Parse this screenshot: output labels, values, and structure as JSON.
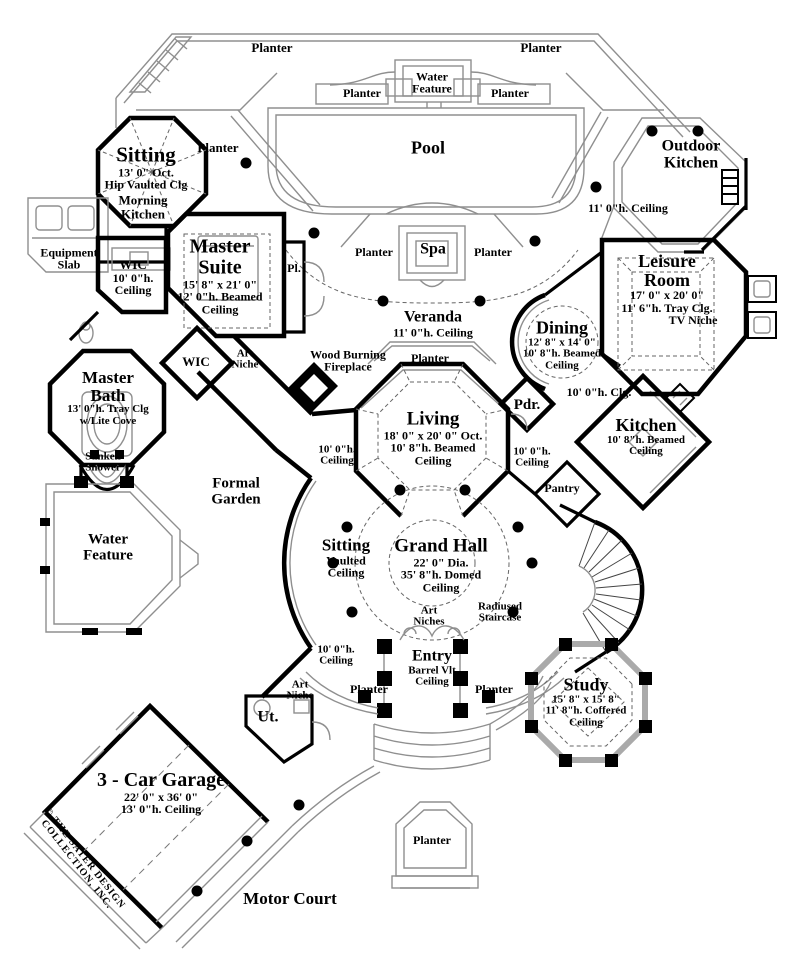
{
  "plan": {
    "outdoor": {
      "planter": "Planter",
      "pool": "Pool",
      "spa": "Spa",
      "water_feature_1": "Water",
      "water_feature_2": "Feature",
      "veranda": "Veranda",
      "ceiling_11": "11' 0\"h. Ceiling",
      "outdoor_kitchen_1": "Outdoor",
      "equipment_slab_1": "Equipment",
      "equipment_slab_2": "Slab",
      "formal_garden_1": "Formal",
      "formal_garden_2": "Garden",
      "motor_court": "Motor Court"
    },
    "rooms": {
      "ceiling_w": "Ceiling",
      "beamed_10_8": "10' 8\"h. Beamed",
      "ceiling_10_h": "10' 0\"h.",
      "sitting": "Sitting",
      "sitting_ne_dim": "13' 0\" Oct.",
      "sitting_ne_clg": "Hip Vaulted Clg",
      "morning_1": "Morning",
      "kitchen": "Kitchen",
      "wic": "WIC",
      "wic_nw_h": "10' 0\"h.",
      "master": "Master",
      "suite": "Suite",
      "suite_dim": "15' 8\" x 21' 0\"",
      "suite_clg": "12' 0\"h. Beamed",
      "pl": "Pl.",
      "leisure_1": "Leisure",
      "leisure_2": "Room",
      "leisure_dim": "17' 0\" x 20' 0\"",
      "leisure_clg": "11' 6\"h. Tray Clg.",
      "tv_niche": "TV Niche",
      "dining": "Dining",
      "dining_dim": "12' 8\" x 14' 0\"",
      "bath": "Bath",
      "bath_clg1": "13' 0\"h. Tray Clg",
      "bath_clg2": "w/Lite Cove",
      "sunken_1": "Sunken",
      "sunken_2": "Shower",
      "art": "Art",
      "niche": "Niche",
      "niches": "Niches",
      "fireplace_1": "Wood Burning",
      "fireplace_2": "Fireplace",
      "pdr": "Pdr.",
      "clg_10": "10' 0\"h. Clg.",
      "living": "Living",
      "living_dim": "18' 0\" x 20' 0\" Oct.",
      "pantry": "Pantry",
      "vaulted": "Vaulted",
      "grand_hall": "Grand Hall",
      "grand_hall_dim": "22' 0\" Dia.",
      "grand_hall_clg": "35' 8\"h. Domed",
      "radiused_1": "Radiused",
      "radiused_2": "Staircase",
      "entry": "Entry",
      "entry_clg": "Barrel Vlt",
      "ut": "Ut.",
      "study": "Study",
      "study_dim": "15' 8\" x 15' 8\"",
      "study_clg": "11' 8\"h. Coffered",
      "garage": "3 - Car Garage",
      "garage_dim": "22' 0\" x 36' 0\"",
      "garage_clg": "13' 0\"h. Ceiling"
    },
    "copyright_1": "© THE SATER DESIGN",
    "copyright_2": "COLLECTION, INC.",
    "colors": {
      "wall": "#000000",
      "outline": "#8f8f8f",
      "paper": "#ffffff"
    }
  }
}
